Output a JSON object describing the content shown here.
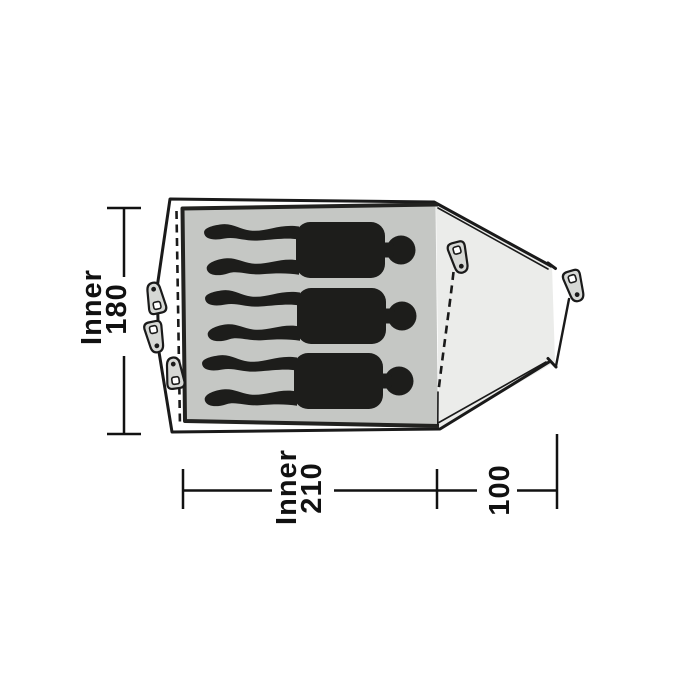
{
  "diagram": {
    "type": "tent-floorplan-top-view",
    "persons_shown": 3,
    "peg_count": 5,
    "labels": {
      "inner_width_label": "Inner",
      "inner_width_value": "180",
      "inner_length_label": "Inner",
      "inner_length_value": "210",
      "porch_depth_value": "100"
    },
    "icons": {
      "peg": "tent-peg-icon",
      "person": "person-silhouette-icon"
    },
    "colors": {
      "line": "#1a1a1a",
      "inner_floor": "#c5c7c4",
      "porch": "#ebecea",
      "peg_fill": "#d6d8d5",
      "peg_hole": "#ffffff",
      "silhouette": "#1d1d1b",
      "background": "#ffffff"
    }
  }
}
